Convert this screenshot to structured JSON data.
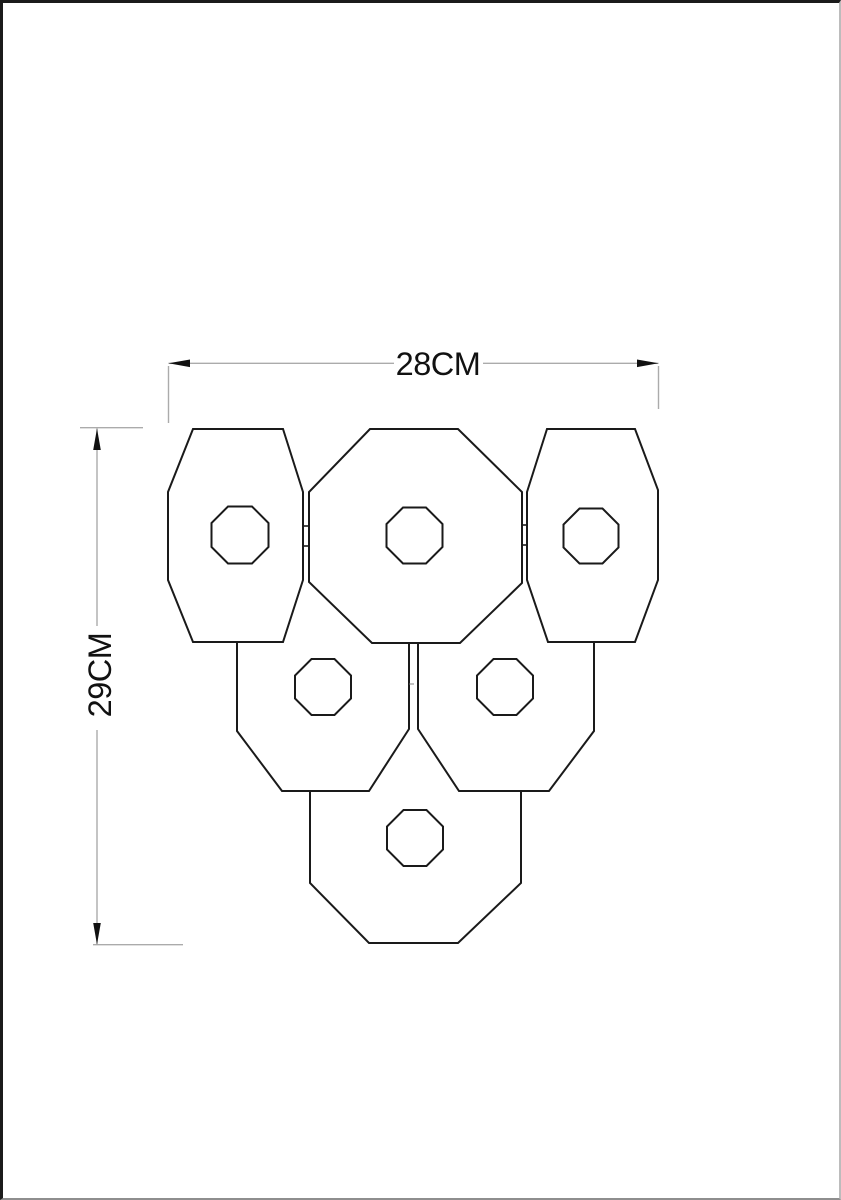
{
  "page": {
    "background": "#ffffff",
    "border_color": "#1b1b1b"
  },
  "drawing": {
    "outline_color": "#1a1a1a",
    "dimension_line_color": "#ababab",
    "arrow_color": "#111111",
    "text_color": "#111111",
    "shades": {
      "top_left": {
        "points": "193,429 283,429 303,492 303,580 283,642 193,642 168,580 168,492"
      },
      "top_center": {
        "points": "370,429 458,429 522,492 522,583 460,643 372,643 309,582 309,492"
      },
      "top_right": {
        "points": "547,429 635,429 658,490 658,580 635,642 548,642 527,580 527,492"
      },
      "mid_left": {
        "points": "237,642 237,731 282,791 369,791 409,729 409,643"
      },
      "mid_right": {
        "points": "418,643 418,729 459,791 549,791 594,731 594,642"
      },
      "bottom": {
        "points": "310,792 310,883 369,943 458,943 521,883 521,792"
      }
    },
    "holes": {
      "top_left": {
        "points": "228,506.5 252,506.5 268.5,523 268.5,547 252,563.5 228,563.5 211.5,547 211.5,523"
      },
      "top_center": {
        "points": "403,507.5 426,507.5 442.5,524 442.5,547 426,563.5 403,563.5 386.5,547 386.5,524"
      },
      "top_right": {
        "points": "579.5,508.5 602.5,508.5 618.5,524.5 618.5,547.5 602.5,563.5 579.5,563.5 563.5,547.5 563.5,524.5"
      },
      "mid_left": {
        "points": "311.5,659 334.5,659 351,675.5 351,698.5 334.5,715 311.5,715 295,698.5 295,675.5"
      },
      "mid_right": {
        "points": "493.5,659 516.5,659 533,675.5 533,698.5 516.5,715 493.5,715 477,698.5 477,675.5"
      },
      "bottom": {
        "points": "403.5,810 426.5,810 443,826.5 443,849.5 426.5,866 403.5,866 387,849.5 387,826.5"
      }
    },
    "connectors": {
      "left_upper": {
        "points": "303,526 309,526"
      },
      "left_lower": {
        "points": "303,546 309,546"
      },
      "right_upper": {
        "points": "522,525 527,525"
      },
      "right_lower": {
        "points": "522,545 527,545"
      },
      "center": {
        "points": "409.5,684 414,684"
      }
    },
    "dimensions": {
      "width": {
        "label": "28CM",
        "line_left": "168.5,363.3 394,363.3",
        "line_right": "483,363.3 658.5,363.3",
        "arrow_left": "168.5,363.3 190,359.5 190,367.1",
        "arrow_right": "658.5,363.3 637,359.5 637,367.1",
        "ext_left": "168.5,366 168.5,423",
        "ext_right": "658.5,366 658.5,409"
      },
      "height": {
        "label": "29CM",
        "line_top": "97,428.5 97,626",
        "line_bottom": "97,730 97,944.5",
        "arrow_top": "97,428.5 93.2,450 100.8,450",
        "arrow_bottom": "97,944.5 93.2,923 100.8,923",
        "ext_top": "80,427.7 143,427.7",
        "ext_bottom": "93,944.7 183,944.7"
      }
    }
  }
}
